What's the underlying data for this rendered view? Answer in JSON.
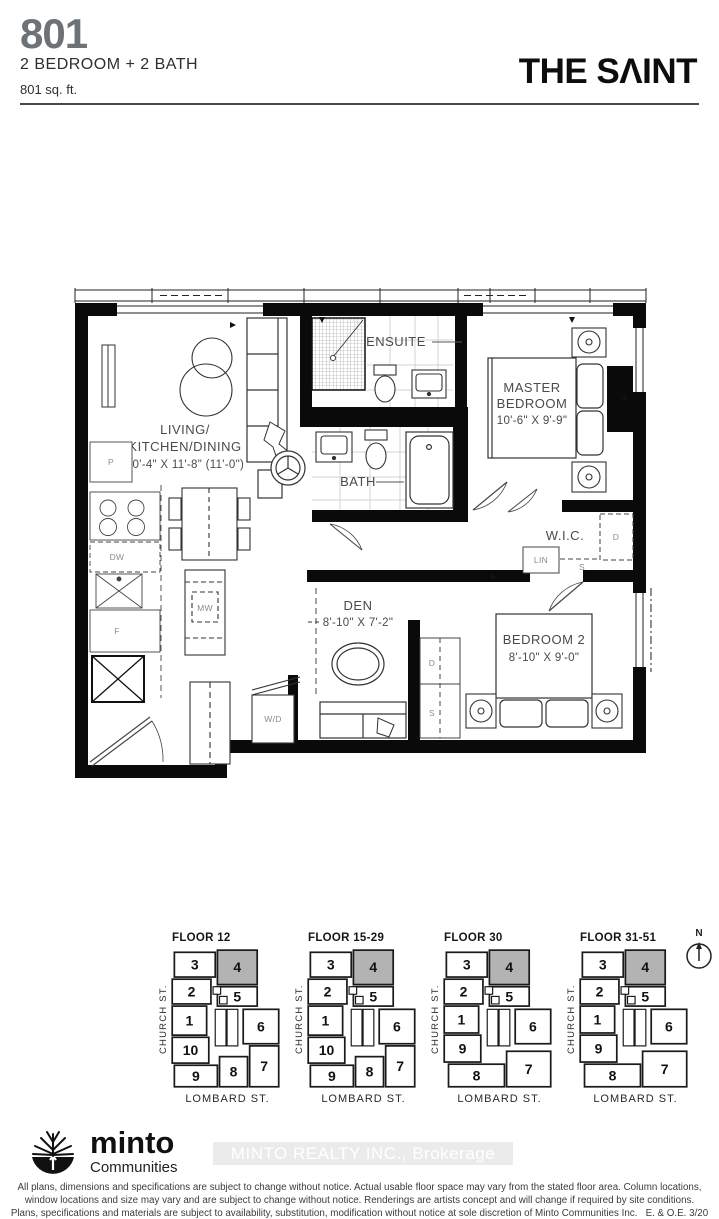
{
  "header": {
    "unit_number": "801",
    "unit_type": "2 BEDROOM + 2 BATH",
    "unit_area": "801 sq. ft.",
    "brand": "THE SΛINT"
  },
  "floorplan": {
    "living": {
      "line1": "LIVING/",
      "line2": "KITCHEN/DINING",
      "dims": "20'-4\" X 11'-8\" (11'-0\")"
    },
    "ensuite": {
      "label": "ENSUITE"
    },
    "bath": {
      "label": "BATH"
    },
    "master": {
      "line1": "MASTER",
      "line2": "BEDROOM",
      "dims": "10'-6\" X 9'-9\""
    },
    "wic": {
      "label": "W.I.C."
    },
    "den": {
      "label": "DEN",
      "dims": "8'-10\" X 7'-2\""
    },
    "bedroom2": {
      "label": "BEDROOM 2",
      "dims": "8'-10\" X 9'-0\""
    },
    "appliances": {
      "pantry": "P",
      "dishwasher": "DW",
      "fridge": "F",
      "microwave": "MW",
      "washer_dryer": "W/D",
      "linen": "LIN",
      "wic_dresser": "D",
      "wic_shelf": "S",
      "bed2_dresser": "D",
      "bed2_shelf": "S"
    }
  },
  "keyplans": {
    "church_street": "CHURCH ST.",
    "lombard_street": "LOMBARD ST.",
    "north": "N",
    "highlighted_unit": "4",
    "highlight_color": "#b3b3b3",
    "floors": [
      {
        "title": "FLOOR 12",
        "variant": "A",
        "units": [
          "3",
          "4",
          "2",
          "5",
          "1",
          "6",
          "10",
          "9",
          "8",
          "7"
        ]
      },
      {
        "title": "FLOOR 15-29",
        "variant": "A",
        "units": [
          "3",
          "4",
          "2",
          "5",
          "1",
          "6",
          "10",
          "9",
          "8",
          "7"
        ]
      },
      {
        "title": "FLOOR 30",
        "variant": "B",
        "units": [
          "3",
          "4",
          "2",
          "5",
          "1",
          "6",
          "9",
          "8",
          "7"
        ]
      },
      {
        "title": "FLOOR 31-51",
        "variant": "B",
        "units": [
          "3",
          "4",
          "2",
          "5",
          "1",
          "6",
          "9",
          "8",
          "7"
        ]
      }
    ]
  },
  "footer": {
    "logo_name": "minto",
    "logo_sub": "Communities",
    "watermark": "MINTO REALTY INC., Brokerage",
    "disclaimer_line1": "All plans, dimensions and specifications are subject to change without notice. Actual usable floor space may vary from the stated floor area. Column locations,",
    "disclaimer_line2": "window locations and size may vary and are subject to change without notice. Renderings are artists concept and will change if required by site conditions.",
    "disclaimer_line3": "Plans, specifications and materials are subject to availability, substitution, modification without notice at sole discretion of Minto Communities Inc.",
    "eoe": "E. & O.E. 3/20"
  }
}
